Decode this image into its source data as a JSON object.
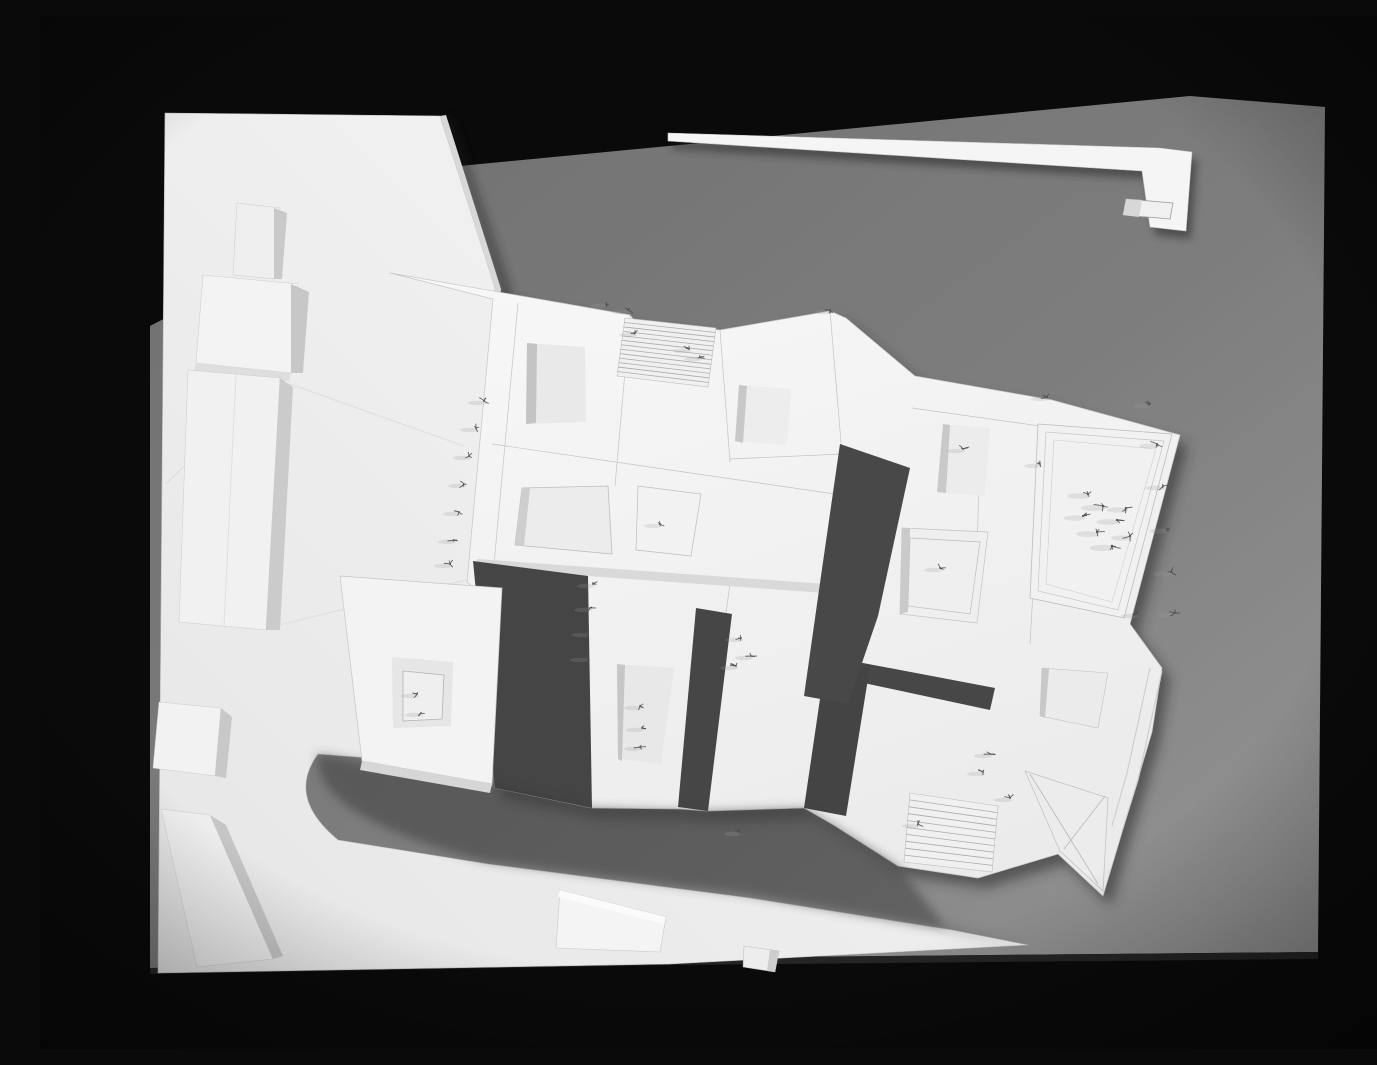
{
  "meta": {
    "title": "Architectural massing model - overhead black and white photograph",
    "description": "Overhead black-and-white photograph of a white architectural site model resting on a dark gray fiber board against a black backdrop. White angular building volumes with recessed courtyards, two striped stair ramps, rows of tiny wire trees, a curved dark road cutout, detached white roof strips at top and bottom, and small solitary blocks on the white base sheet at left."
  },
  "palette": {
    "background": "#0a0a0a",
    "board_dark": "#4a4a4a",
    "board_light": "#757575",
    "channel": "#464646",
    "paper_bright": "#f7f7f7",
    "paper_shade": "#d6d6d6",
    "courtyard": "#e9e9e9",
    "seam": "#c6c6c6",
    "tree": "#4f4f4f"
  },
  "scene": {
    "canvas": {
      "w": 1377,
      "h": 1033
    },
    "layers": [
      {
        "name": "backdrop-black",
        "type": "poly",
        "points": "0,0 1377,0 1377,1033 0,1033",
        "fill": "#0a0a0a"
      },
      {
        "name": "board-base",
        "type": "poly",
        "points": "420,150 1150,80 1285,91 1278,936 630,942 110,952 110,310",
        "fill": "url(#gboard)"
      },
      {
        "name": "board-speckle",
        "type": "poly",
        "points": "420,150 1150,80 1285,91 1278,936 630,942 110,952 110,310",
        "fill": "#ffffff",
        "filter": "url(#speck)",
        "opacity": 0.22
      },
      {
        "name": "board-bottom-edge",
        "type": "poly",
        "points": "1278,936 630,942 110,952 110,958 630,949 1278,943",
        "fill": "#252525"
      },
      {
        "name": "shadow-building-complex",
        "type": "poly",
        "points": "358,267 598,309 602,314 688,324 798,305 814,312 883,370 1020,394 1148,429 1098,618 1130,662 1120,726 1071,890 1026,848 946,872 866,860 803,820 772,802 676,805 648,803 560,802 463,782 470,605 435,576 461,293",
        "fill": "#232323",
        "opacity": 0.5,
        "filter": "url(#b6)"
      },
      {
        "name": "shadow-roof-strip",
        "type": "poly",
        "points": "633,125 1125,140 1157,144 1151,223 1115,219 1107,163 633,133",
        "fill": "#232323",
        "opacity": 0.5,
        "filter": "url(#b4)"
      },
      {
        "name": "shadow-sheet-edge",
        "type": "poly",
        "points": "405,103 460,275 432,569 467,598 457,773 470,773 478,598 445,570 472,276 412,101",
        "fill": "#1f1f1f",
        "opacity": 0.45,
        "filter": "url(#b5)"
      },
      {
        "name": "base-sheet",
        "type": "path",
        "d": "M125,97 L400,100 L455,272 L427,566 L462,595 L452,770 L330,742 L278,738 Q246,781 298,824 L448,848 L710,882 L912,914 L988,929 L630,948 L118,957 Z",
        "fill": "url(#gsheet)",
        "stroke": "#bfbfbf",
        "sw": 0.6
      },
      {
        "name": "sheet-creases",
        "type": "segs",
        "segs": [
          [
            240,
            356,
            126,
            468
          ],
          [
            250,
            368,
            424,
            430
          ],
          [
            226,
            612,
            426,
            564
          ]
        ],
        "stroke": "#dedede",
        "sw": 1.1
      },
      {
        "name": "sheet-edge-face",
        "type": "poly",
        "points": "400,100 455,272 427,566 433,567 461,273 406,99",
        "fill": "#d8d8d8"
      },
      {
        "name": "tower-bar",
        "type": "poly",
        "points": "197,187 240,192 234,263 193,259",
        "fill": "#efefef",
        "stroke": "#cccccc",
        "sw": 0.5
      },
      {
        "name": "tower-bar-side",
        "type": "poly",
        "points": "234,192 247,197 242,263 234,263",
        "fill": "#c9c9c9"
      },
      {
        "name": "cube-block",
        "type": "poly",
        "points": "163,259 258,268 251,357 156,347",
        "fill": "#f3f3f3",
        "stroke": "#cccccc",
        "sw": 0.5
      },
      {
        "name": "cube-block-side",
        "type": "poly",
        "points": "251,268 269,276 263,357 251,357",
        "fill": "#c7c7c7"
      },
      {
        "name": "cube-block-base",
        "type": "poly",
        "points": "156,347 251,357 249,365 154,355",
        "fill": "#dedede"
      },
      {
        "name": "slab-building",
        "type": "poly",
        "points": "148,354 240,362 226,614 139,606",
        "fill": "#f1f1f1",
        "stroke": "#cccccc",
        "sw": 0.5
      },
      {
        "name": "slab-building-side",
        "type": "poly",
        "points": "240,362 253,371 240,614 226,614",
        "fill": "#cbcbcb"
      },
      {
        "name": "slab-building-fold",
        "type": "segs",
        "segs": [
          [
            196,
            359,
            184,
            611
          ]
        ],
        "stroke": "#e0e0e0",
        "sw": 1
      },
      {
        "name": "small-cube",
        "type": "poly",
        "points": "119,686 181,692 175,760 113,752",
        "fill": "#f2f2f2",
        "stroke": "#cccccc",
        "sw": 0.5
      },
      {
        "name": "small-cube-side",
        "type": "poly",
        "points": "181,692 192,701 186,762 175,760",
        "fill": "#c8c8c8"
      },
      {
        "name": "wedge-building",
        "type": "poly",
        "points": "121,793 170,799 233,943 157,951",
        "fill": "#eeeeee",
        "stroke": "#cccccc",
        "sw": 0.5
      },
      {
        "name": "wedge-building-side",
        "type": "poly",
        "points": "170,799 186,809 243,940 233,943",
        "fill": "#c6c6c6"
      },
      {
        "name": "roof-strip-l",
        "type": "path",
        "d": "M628,117 L1120,132 L1152,136 L1146,215 L1110,211 L1102,155 L628,125 Z",
        "fill": "#f5f5f5",
        "stroke": "#c9c9c9",
        "sw": 0.6
      },
      {
        "name": "roof-strip-notch",
        "type": "poly",
        "points": "1086,183 1133,187 1130,203 1083,199",
        "fill": "#f0f0f0",
        "stroke": "#9e9e9e",
        "sw": 0.8
      },
      {
        "name": "roof-strip-notch-half",
        "type": "poly",
        "points": "1086,183 1102,184 1099,201 1083,199",
        "fill": "#d7d7d7"
      },
      {
        "name": "building-complex",
        "type": "poly",
        "points": "350,257 590,299 594,304 680,314 790,295 806,302 875,360 1012,384 1140,419 1090,608 1122,652 1112,716 1063,880 1018,838 938,862 858,850 795,810 764,792 668,795 640,793 552,792 455,772 462,595 427,566 453,283",
        "fill": "url(#gwhite)",
        "stroke": "#c6c6c6",
        "sw": 0.7
      },
      {
        "name": "roof-seams",
        "type": "segs",
        "segs": [
          [
            590,
            299,
            575,
            470
          ],
          [
            680,
            314,
            690,
            446
          ],
          [
            790,
            295,
            802,
            438
          ],
          [
            690,
            443,
            802,
            438
          ],
          [
            452,
            428,
            795,
            478
          ],
          [
            478,
            287,
            452,
            570
          ],
          [
            872,
            392,
            1000,
            410
          ],
          [
            940,
            432,
            935,
            605
          ],
          [
            1000,
            455,
            990,
            628
          ],
          [
            545,
            555,
            690,
            568
          ],
          [
            690,
            568,
            658,
            795
          ],
          [
            545,
            555,
            548,
            770
          ]
        ],
        "stroke": "#c3c3c3",
        "sw": 0.7
      },
      {
        "name": "band-south-face",
        "type": "poly",
        "points": "437,543 786,568 785,577 436,552",
        "fill": "#d9d9d9"
      },
      {
        "name": "gap-channel-1",
        "type": "poly",
        "points": "433,545 548,560 552,792 455,772",
        "fill": "#454545"
      },
      {
        "name": "gap-channel-2",
        "type": "poly",
        "points": "656,592 692,598 668,795 638,791",
        "fill": "#464646"
      },
      {
        "name": "gap-channel-3h",
        "type": "poly",
        "points": "786,640 955,672 950,694 782,658",
        "fill": "#474747"
      },
      {
        "name": "gap-channel-3v",
        "type": "poly",
        "points": "786,642 830,650 806,800 764,792",
        "fill": "#444444"
      },
      {
        "name": "gap-channel-4",
        "type": "poly",
        "points": "800,428 870,452 838,600 808,688 764,680 781,560",
        "fill": "#484848"
      },
      {
        "name": "road-shadow",
        "type": "path",
        "d": "M278,738 L452,768 L552,792 L668,795 L764,792 L795,810 L858,850 L905,910 L985,928 L700,878 L448,846 Q270,800 278,738 Z",
        "fill": "#383838",
        "opacity": 0.5,
        "filter": "url(#b5)"
      },
      {
        "name": "courtyard-building-sw",
        "type": "poly",
        "points": "300,560 462,572 452,768 322,745",
        "fill": "#f3f3f3",
        "stroke": "#c6c6c6",
        "sw": 0.7
      },
      {
        "name": "courtyard-building-sw-face",
        "type": "poly",
        "points": "322,745 452,768 450,777 320,754",
        "fill": "#d6d6d6"
      },
      {
        "name": "courtyard-sw",
        "type": "poly",
        "points": "352,641 413,646 411,710 353,712",
        "fill": "#e6e6e6"
      },
      {
        "name": "courtyard-sw-frame",
        "type": "poly",
        "points": "363,655 404,659 402,703 363,705",
        "fill": "#efefef",
        "stroke": "#b3b3b3",
        "sw": 0.8
      },
      {
        "name": "courtyard-nw",
        "type": "poly",
        "points": "487,327 545,331 546,406 486,408",
        "fill": "#e9e9e9"
      },
      {
        "name": "courtyard-nw-shadow",
        "type": "poly",
        "points": "487,327 497,328 496,407 486,408",
        "fill": "#c4c4c4"
      },
      {
        "name": "courtyard-n",
        "type": "poly",
        "points": "699,369 751,373 747,429 695,425",
        "fill": "#ededed"
      },
      {
        "name": "courtyard-n-shadow",
        "type": "poly",
        "points": "699,369 707,370 703,427 695,425",
        "fill": "#c8c8c8"
      },
      {
        "name": "courtyard-mid",
        "type": "poly",
        "points": "482,472 568,470 572,538 475,529",
        "fill": "#ececec",
        "stroke": "#bdbdbd",
        "sw": 0.8
      },
      {
        "name": "courtyard-mid-shadow",
        "type": "poly",
        "points": "482,472 490,472 484,530 475,529",
        "fill": "#cecece"
      },
      {
        "name": "ground-trapezoid",
        "type": "poly",
        "points": "598,470 661,478 651,540 596,534",
        "fill": "#f2f2f2",
        "stroke": "#bcbcbc",
        "sw": 0.7
      },
      {
        "name": "courtyard-s",
        "type": "poly",
        "points": "577,648 634,652 621,748 578,743",
        "fill": "#e8e8e8"
      },
      {
        "name": "courtyard-s-shadow",
        "type": "poly",
        "points": "577,648 585,649 582,745 578,743",
        "fill": "#c6c6c6"
      },
      {
        "name": "courtyard-e1",
        "type": "poly",
        "points": "903,408 950,412 945,480 897,476",
        "fill": "#ececec"
      },
      {
        "name": "courtyard-e1-shadow",
        "type": "poly",
        "points": "903,408 910,409 906,477 897,476",
        "fill": "#c9c9c9"
      },
      {
        "name": "courtyard-e2",
        "type": "poly",
        "points": "862,512 948,516 937,607 860,598",
        "fill": "#efefef",
        "stroke": "#c2c2c2",
        "sw": 0.7
      },
      {
        "name": "courtyard-e2-frame",
        "type": "poly",
        "points": "870,522 940,526 930,598 868,590",
        "fill": "none",
        "stroke": "#bdbdbd",
        "sw": 0.7
      },
      {
        "name": "courtyard-e2-shadow",
        "type": "poly",
        "points": "862,512 870,513 868,596 860,598",
        "fill": "#cacaca"
      },
      {
        "name": "great-courtyard",
        "type": "poly",
        "points": "998,408 1132,418 1084,602 990,582",
        "fill": "#f1f1f1",
        "stroke": "#bdbdbd",
        "sw": 0.8
      },
      {
        "name": "great-courtyard-frame1",
        "type": "poly",
        "points": "1006,416 1124,425 1078,594 998,575",
        "fill": "none",
        "stroke": "#c6c6c6",
        "sw": 0.7
      },
      {
        "name": "great-courtyard-frame2",
        "type": "poly",
        "points": "1014,424 1116,433 1072,586 1006,568",
        "fill": "none",
        "stroke": "#cfcfcf",
        "sw": 0.6
      },
      {
        "name": "courtyard-se-pad",
        "type": "poly",
        "points": "1002,652 1068,657 1058,712 1000,700",
        "fill": "#ebebeb",
        "stroke": "#c0c0c0",
        "sw": 0.6
      },
      {
        "name": "courtyard-se-pad-shadow",
        "type": "poly",
        "points": "1002,652 1009,653 1005,702 1000,700",
        "fill": "#c8c8c8"
      },
      {
        "name": "funnel-court",
        "type": "poly",
        "points": "985,755 1068,782 1063,875 1020,835",
        "fill": "#ececec",
        "stroke": "#c0c0c0",
        "sw": 0.7
      },
      {
        "name": "funnel-court-diagonals",
        "type": "segs",
        "segs": [
          [
            990,
            758,
            1058,
            868
          ],
          [
            1065,
            780,
            1024,
            833
          ]
        ],
        "stroke": "#b8b8b8",
        "sw": 0.8
      },
      {
        "name": "se-roof-steps",
        "type": "segs",
        "segs": [
          [
            1110,
            652,
            1087,
            757
          ],
          [
            1087,
            757,
            1072,
            810
          ],
          [
            1122,
            655,
            1098,
            764
          ],
          [
            1098,
            764,
            1082,
            815
          ]
        ],
        "stroke": "#cfcfcf",
        "sw": 1.2
      },
      {
        "name": "stair-ramp-north",
        "type": "stairs",
        "corners": [
          585,
          302,
          676,
          312,
          668,
          371,
          577,
          360
        ],
        "n": 12,
        "base": "#f0f0f0",
        "lc": "#ababab"
      },
      {
        "name": "stair-ramp-south",
        "type": "stairs",
        "corners": [
          870,
          777,
          958,
          790,
          952,
          856,
          864,
          846
        ],
        "n": 9,
        "base": "#f0f0f0",
        "lc": "#ababab"
      },
      {
        "name": "bottom-pad",
        "type": "poly",
        "points": "520,874 626,901 620,936 516,932",
        "fill": "#f4f4f4",
        "stroke": "#c9c9c9",
        "sw": 0.6
      },
      {
        "name": "bottom-pad-top",
        "type": "poly",
        "points": "520,874 626,901 624,908 518,881",
        "fill": "#fbfbfb"
      },
      {
        "name": "bottom-cube",
        "type": "poly",
        "points": "704,930 739,935 735,956 703,951",
        "fill": "#ededed",
        "stroke": "#bbbbbb",
        "sw": 0.5
      },
      {
        "name": "bottom-cube-side",
        "type": "poly",
        "points": "730,934 739,935 735,956 727,955",
        "fill": "#cdcdcd"
      },
      {
        "name": "trees",
        "type": "trees",
        "color": "#4a4a4a",
        "smudge": "#9a9a9a",
        "items": [
          [
            444,
            385
          ],
          [
            436,
            412
          ],
          [
            429,
            440
          ],
          [
            424,
            468
          ],
          [
            419,
            496
          ],
          [
            414,
            524
          ],
          [
            410,
            548
          ],
          [
            553,
            568
          ],
          [
            550,
            592
          ],
          [
            548,
            617
          ],
          [
            546,
            642
          ],
          [
            600,
            690
          ],
          [
            602,
            712
          ],
          [
            600,
            731
          ],
          [
            377,
            678
          ],
          [
            381,
            697
          ],
          [
            620,
            508
          ],
          [
            701,
            622
          ],
          [
            711,
            640
          ],
          [
            696,
            650
          ],
          [
            700,
            816
          ],
          [
            566,
            288
          ],
          [
            588,
            294
          ],
          [
            595,
            317
          ],
          [
            649,
            333
          ],
          [
            660,
            341
          ],
          [
            790,
            294
          ],
          [
            923,
            433
          ],
          [
            900,
            552
          ],
          [
            1000,
            448
          ],
          [
            1048,
            478,
            1.3
          ],
          [
            1063,
            490,
            1.4
          ],
          [
            1077,
            504,
            1.3
          ],
          [
            1057,
            516,
            1.3
          ],
          [
            1072,
            530,
            1.4
          ],
          [
            1086,
            492,
            1.2
          ],
          [
            1090,
            520,
            1.2
          ],
          [
            1043,
            500,
            1.2
          ],
          [
            1110,
            388,
            1.1
          ],
          [
            1117,
            428,
            1.1
          ],
          [
            1123,
            470,
            1.1
          ],
          [
            1127,
            513,
            1.1
          ],
          [
            1131,
            556,
            1.1
          ],
          [
            1135,
            597,
            1.1
          ],
          [
            1007,
            381
          ],
          [
            950,
            738
          ],
          [
            943,
            756
          ],
          [
            970,
            782
          ],
          [
            878,
            808
          ],
          [
            1097,
            598
          ]
        ]
      },
      {
        "name": "vignette",
        "type": "rect",
        "x": 0,
        "y": 0,
        "w": 1377,
        "h": 1033,
        "fill": "url(#vig)"
      }
    ]
  }
}
